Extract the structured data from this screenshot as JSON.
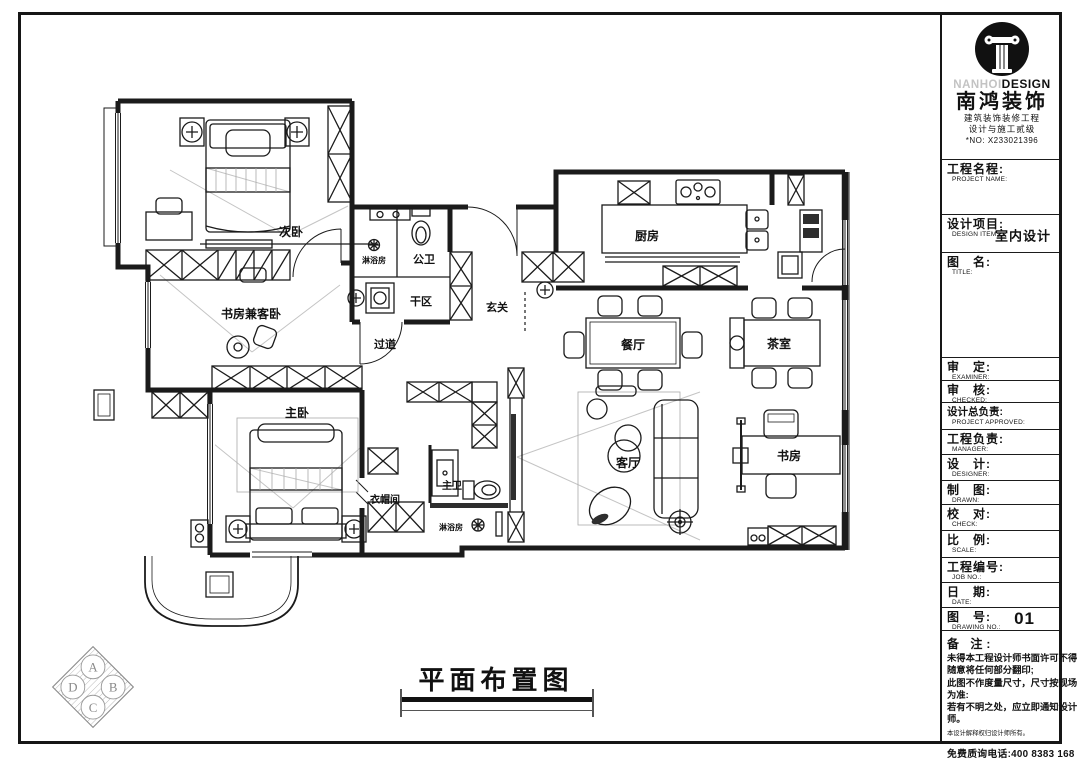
{
  "title_block": {
    "logo": {
      "brand_light": "NANHOI",
      "brand_bold": "DESIGN",
      "company": "南鸿装饰",
      "cert_line1": "建筑装饰装修工程",
      "cert_line2": "设计与施工贰级",
      "cert_no": "*NO: X233021396"
    },
    "fields": [
      {
        "cn": "工程名程:",
        "en": "PROJECT NAME:",
        "value": ""
      },
      {
        "cn": "设计项目:",
        "en": "DESIGN ITEM:",
        "value": "室内设计"
      },
      {
        "cn": "图　名:",
        "en": "TITLE:",
        "value": ""
      },
      {
        "cn": "审　定:",
        "en": "EXAMINER:",
        "value": ""
      },
      {
        "cn": "审　核:",
        "en": "CHECKED:",
        "value": ""
      },
      {
        "cn": "设计总负责:",
        "en": "PROJECT APPROVED:",
        "value": ""
      },
      {
        "cn": "工程负责:",
        "en": "MANAGER:",
        "value": ""
      },
      {
        "cn": "设　计:",
        "en": "DESIGNER:",
        "value": ""
      },
      {
        "cn": "制　图:",
        "en": "DRAWN:",
        "value": ""
      },
      {
        "cn": "校　对:",
        "en": "CHECK:",
        "value": ""
      },
      {
        "cn": "比　例:",
        "en": "SCALE:",
        "value": ""
      },
      {
        "cn": "工程编号:",
        "en": "JOB  NO.:",
        "value": ""
      },
      {
        "cn": "日　期:",
        "en": "DATE:",
        "value": ""
      },
      {
        "cn": "图　号:",
        "en": "DRAWING NO.:",
        "value": "01"
      }
    ],
    "notes": {
      "label": "备 注:",
      "lines": [
        "未得本工程设计师书面许可不得",
        "随意将任何部分翻印;",
        "此图不作度量尺寸，尺寸按现场",
        "为准:",
        "若有不明之处，应立即通知设计",
        "师。"
      ],
      "disclaimer": "本设计解释权归设计师所有。",
      "hotline": "免费质询电话:400 8383 168"
    }
  },
  "plan": {
    "title": "平面布置图",
    "rooms": [
      {
        "label": "次卧"
      },
      {
        "label": "书房兼客卧"
      },
      {
        "label": "淋浴房"
      },
      {
        "label": "公卫"
      },
      {
        "label": "干区"
      },
      {
        "label": "玄关"
      },
      {
        "label": "过道"
      },
      {
        "label": "厨房"
      },
      {
        "label": "餐厅"
      },
      {
        "label": "茶室"
      },
      {
        "label": "客厅"
      },
      {
        "label": "书房"
      },
      {
        "label": "主卧"
      },
      {
        "label": "衣帽间"
      },
      {
        "label": "主卫"
      },
      {
        "label": "淋浴房"
      }
    ],
    "compass": [
      "A",
      "B",
      "C",
      "D"
    ]
  },
  "colors": {
    "line": "#1b1b1b",
    "projection_gray": "#c4c4c4",
    "brand_gray": "#c3c3c3"
  }
}
